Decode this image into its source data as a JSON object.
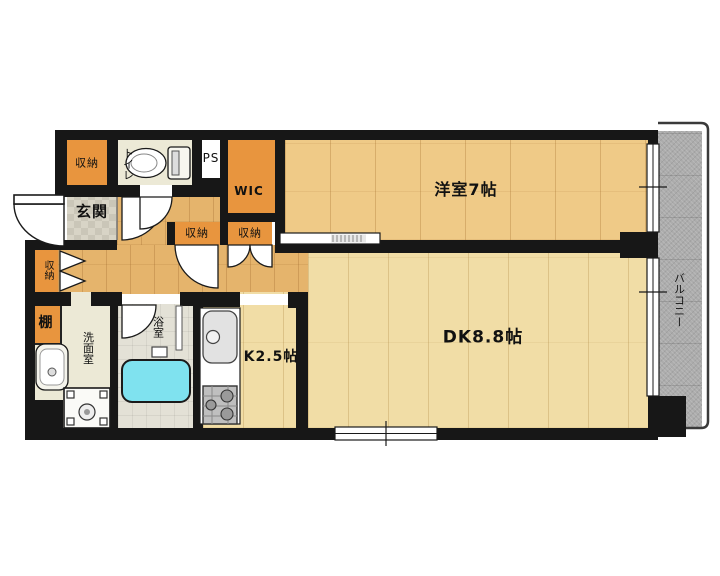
{
  "plan": {
    "labels": {
      "western_room": "洋室7帖",
      "dining_kitchen": "DK8.8帖",
      "kitchen": "K2.5帖",
      "balcony": "バルコニー",
      "entrance": "玄関",
      "toilet": "トイレ",
      "pipe_space": "PS",
      "walk_in_closet": "WIC",
      "washroom": "洗面室",
      "bathroom": "浴室",
      "shelf": "棚",
      "storage_top": "収納",
      "storage_hall": "収納",
      "storage_mid_left": "収納",
      "storage_mid_right": "収納"
    },
    "colors": {
      "wall": "#171717",
      "storage_orange": "#E8953E",
      "hall_wood": "#E5B46C",
      "room_wood": "#EFCA87",
      "dk_wood": "#F1DDA6",
      "service_floor": "#ECE9D6",
      "bathtub_cyan": "#7FE2EF",
      "balcony_gray": "#ACACAC"
    }
  }
}
